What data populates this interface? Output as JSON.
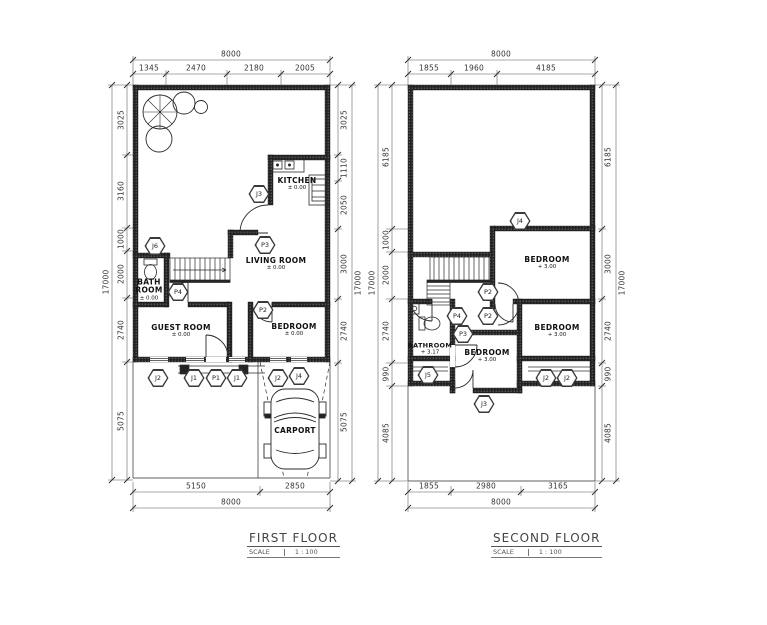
{
  "plans": [
    {
      "title": "FIRST FLOOR",
      "scale_label": "SCALE",
      "scale_value": "1 : 100",
      "dims": {
        "top_total": "8000",
        "top": [
          "1345",
          "2470",
          "2180",
          "2005"
        ],
        "left_total": "17000",
        "left": [
          "3025",
          "3160",
          "1000",
          "2000",
          "2740",
          "5075"
        ],
        "right_total": "17000",
        "right": [
          "3025",
          "1110",
          "2050",
          "3000",
          "2740",
          "5075"
        ],
        "bottom": [
          "5150",
          "2850"
        ],
        "bottom_total": "8000"
      },
      "rooms": {
        "kitchen": {
          "name": "KITCHEN",
          "elev": "± 0.00"
        },
        "living": {
          "name": "LIVING ROOM",
          "elev": "± 0.00"
        },
        "bath": {
          "name": "BATH ROOM",
          "elev": "± 0.00"
        },
        "guest": {
          "name": "GUEST ROOM",
          "elev": "± 0.00"
        },
        "bedroom": {
          "name": "BEDROOM",
          "elev": "± 0.00"
        },
        "carport": {
          "name": "CARPORT"
        }
      },
      "markers": [
        "J6",
        "J3",
        "P3",
        "P2",
        "P4",
        "J2",
        "J1",
        "P1",
        "J1",
        "J2",
        "J4"
      ]
    },
    {
      "title": "SECOND FLOOR",
      "scale_label": "SCALE",
      "scale_value": "1 : 100",
      "dims": {
        "top_total": "8000",
        "top": [
          "1855",
          "1960",
          "4185"
        ],
        "left_total": "17000",
        "left": [
          "6185",
          "1000",
          "2000",
          "2740",
          "990",
          "4085"
        ],
        "right_total": "17000",
        "right": [
          "6185",
          "3000",
          "2740",
          "990",
          "4085"
        ],
        "bottom": [
          "1855",
          "2980",
          "3165"
        ],
        "bottom_total": "8000"
      },
      "rooms": {
        "bedroom_a": {
          "name": "BEDROOM",
          "elev": "+ 3.00"
        },
        "bedroom_b": {
          "name": "BEDROOM",
          "elev": "+ 3.00"
        },
        "bedroom_c": {
          "name": "BEDROOM",
          "elev": "+ 3.00"
        },
        "bathroom": {
          "name": "BATHROOM",
          "elev": "+ 3.17"
        }
      },
      "markers": [
        "J4",
        "P2",
        "P2",
        "P4",
        "P3",
        "J5",
        "J3",
        "J2",
        "J2"
      ]
    }
  ]
}
